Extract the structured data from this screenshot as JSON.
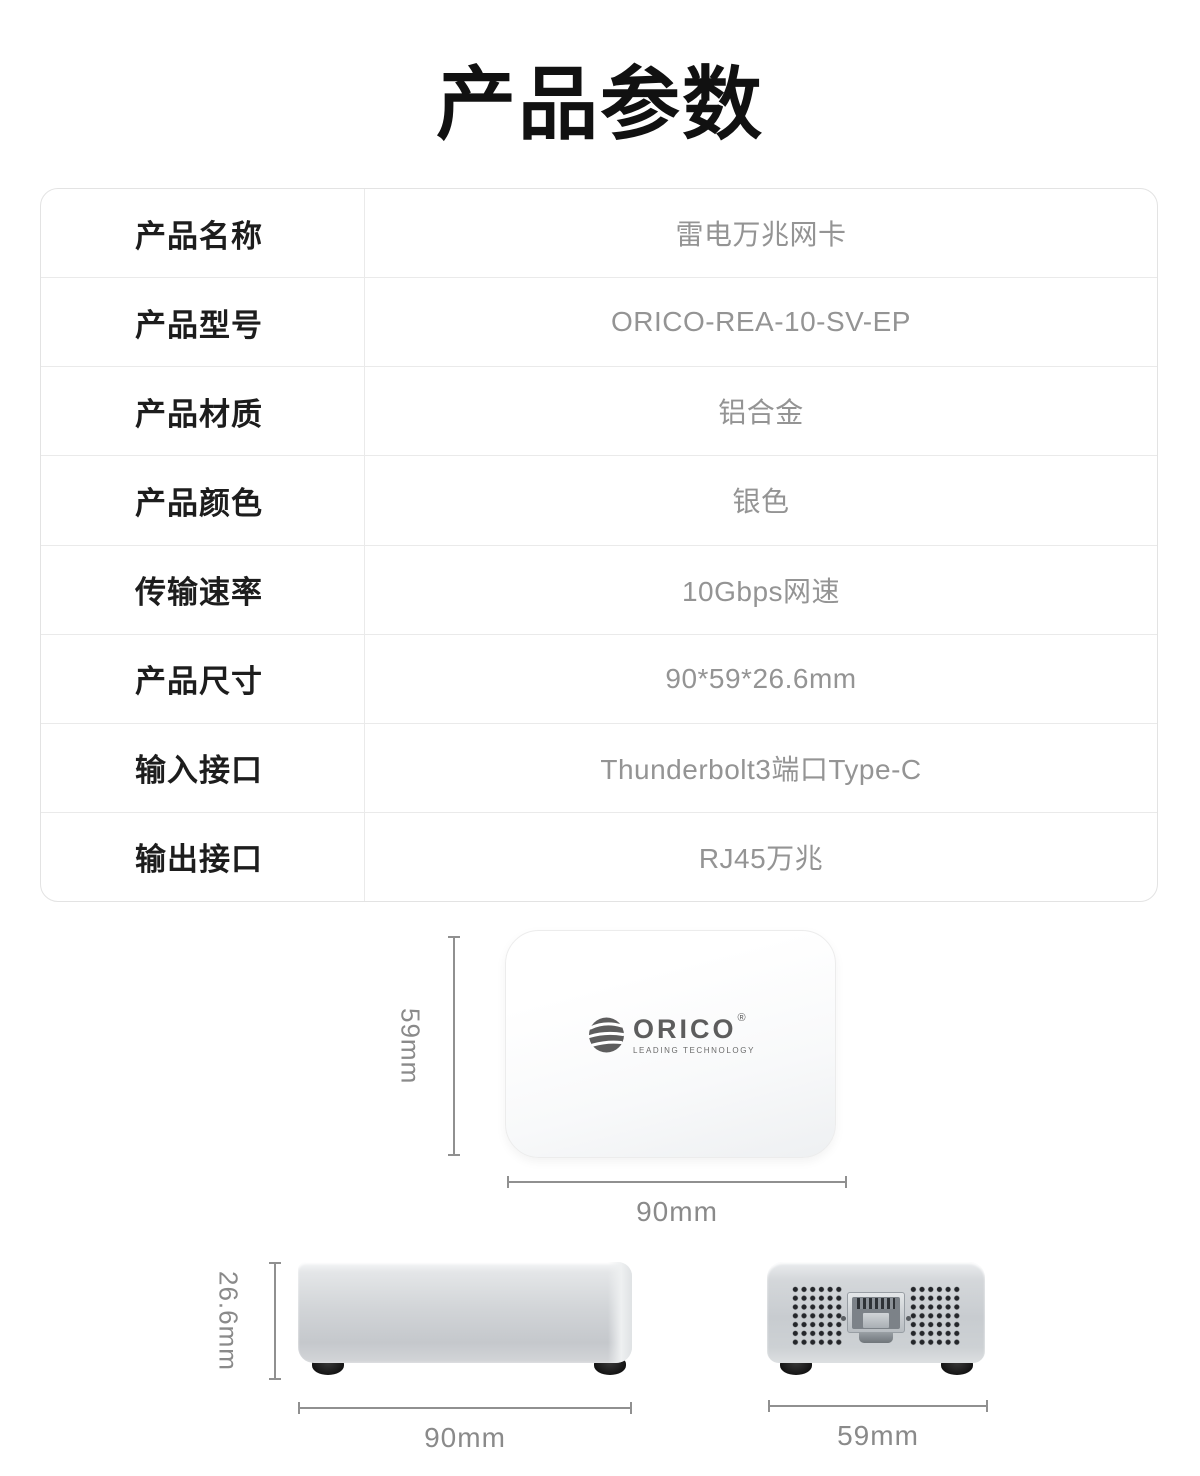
{
  "page": {
    "title": "产品参数"
  },
  "colors": {
    "title_text": "#111111",
    "label_text": "#1d1d1d",
    "value_text": "#949494",
    "table_border": "#eaeaea",
    "dimension_gray": "#8a8a8a",
    "logo_gray": "#5d5d5d",
    "device_silver": "#cdd1d4"
  },
  "spec_table": {
    "rows": [
      {
        "label": "产品名称",
        "value": "雷电万兆网卡"
      },
      {
        "label": "产品型号",
        "value": "ORICO-REA-10-SV-EP"
      },
      {
        "label": "产品材质",
        "value": "铝合金"
      },
      {
        "label": "产品颜色",
        "value": "银色"
      },
      {
        "label": "传输速率",
        "value": "10Gbps网速"
      },
      {
        "label": "产品尺寸",
        "value": "90*59*26.6mm"
      },
      {
        "label": "输入接口",
        "value": "Thunderbolt3端口Type-C"
      },
      {
        "label": "输出接口",
        "value": "RJ45万兆"
      }
    ]
  },
  "diagrams": {
    "top_view": {
      "height_label": "59mm",
      "width_label": "90mm",
      "logo": {
        "brand": "ORICO",
        "registered": "®",
        "tagline": "LEADING  TECHNOLOGY"
      }
    },
    "side_view": {
      "height_label": "26.6mm",
      "width_label": "90mm"
    },
    "front_view": {
      "width_label": "59mm"
    }
  }
}
